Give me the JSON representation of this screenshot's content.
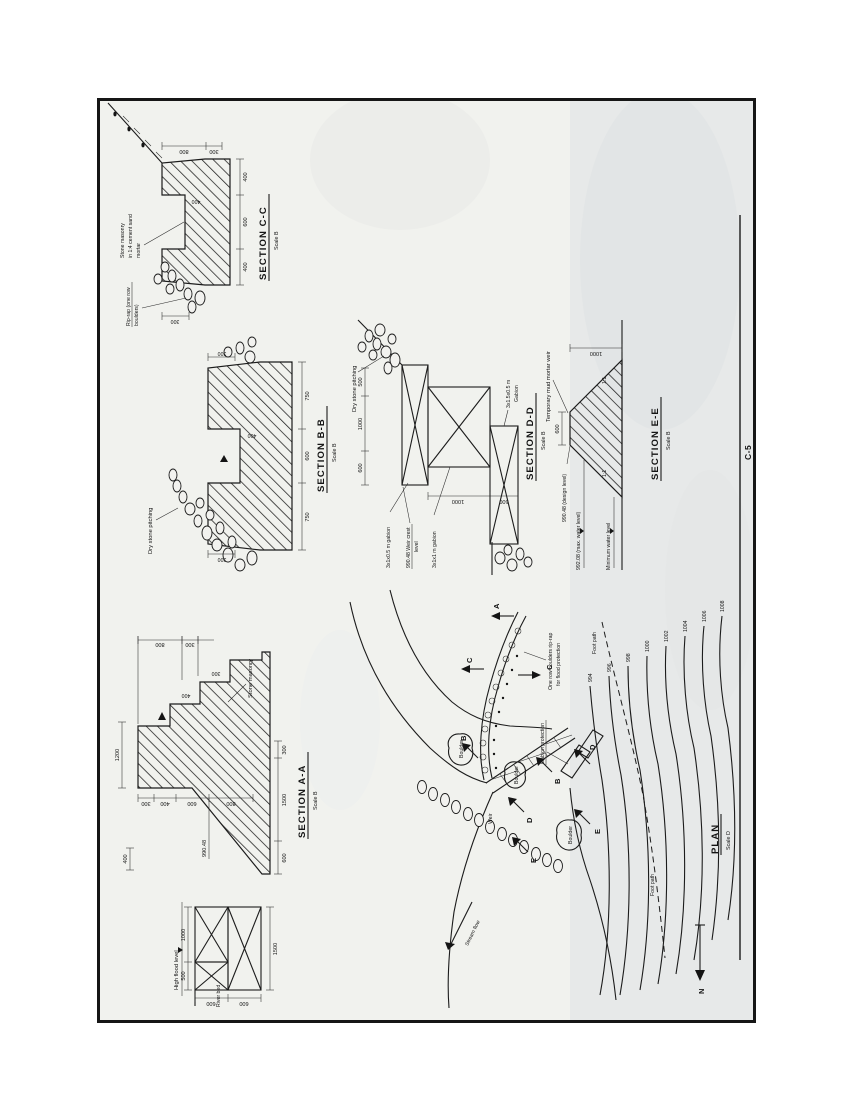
{
  "sheet": {
    "number": "C-5"
  },
  "sections": {
    "aa": {
      "title": "SECTION A-A",
      "scale": "Scale B",
      "labels": {
        "stone_masonry": "Stone masonry",
        "high_flood_level": "High flood level",
        "river_bed": "River bed",
        "crest_level": "990.48"
      },
      "dims": {
        "top_400": "400",
        "top_1200": "1200",
        "face": [
          "300",
          "400",
          "600",
          "800"
        ],
        "right": [
          "800",
          "300"
        ],
        "step": [
          "400",
          "300"
        ],
        "gabion_top": [
          "500",
          "1000"
        ],
        "gabion_left": [
          "600",
          "600"
        ],
        "gabion_width": "1500",
        "bottom": [
          "600",
          "1500",
          "300"
        ]
      }
    },
    "bb": {
      "title": "SECTION B-B",
      "scale": "Scale B",
      "labels": {
        "dry_stone": "Dry stone pitching"
      },
      "dims": {
        "bottom": [
          "750",
          "600",
          "750"
        ],
        "left_300": "300",
        "right_300": "300",
        "notch_400": "400"
      }
    },
    "cc": {
      "title": "SECTION C-C",
      "scale": "Scale B",
      "labels": {
        "riprap_1": "Rip-rap (one row",
        "riprap_2": "boulders)",
        "masonry_1": "Stone masonry",
        "masonry_2": "in 1:4 cement sand",
        "masonry_3": "mortar"
      },
      "dims": {
        "bottom": [
          "400",
          "600",
          "400"
        ],
        "right": [
          "800",
          "300"
        ],
        "left_300": "300",
        "notch_400": "400"
      }
    },
    "dd": {
      "title": "SECTION D-D",
      "scale": "Scale B",
      "labels": {
        "dry_stone": "Dry stone pitching",
        "gabion_small": "3x1x0.5 m gabion",
        "crest_1": "990.48 Weir crest",
        "crest_2": "level",
        "gabion_big": "3x1x1 m gabion",
        "gabion_right_1": "3x1.5x0.5 m",
        "gabion_right_2": "Gabion"
      },
      "dims": {
        "top": [
          "600",
          "1000",
          "500"
        ],
        "left": [
          "1000",
          "500"
        ]
      }
    },
    "ee": {
      "title": "SECTION E-E",
      "scale": "Scale B",
      "labels": {
        "temporary": "Temporary mud mortar weir",
        "design_level": "990.48 (design level)",
        "max_water": "992.08 (max. water level)",
        "min_water": "Minimum water level",
        "slope_left": "1:1",
        "slope_right": "1:1"
      },
      "dims": {
        "crest": "600",
        "height": "1000"
      }
    }
  },
  "plan": {
    "title": "PLAN",
    "scale": "Scale D",
    "labels": {
      "weir": "Weir",
      "gabion_protection": "Gabion protection",
      "one_row_1": "One row boulders rip-rap",
      "one_row_2": "for flood protection",
      "boulder": "Boulder",
      "stream_flow": "Stream flow",
      "foot_path": "Foot path",
      "north": "N"
    },
    "cuts": {
      "a": "A",
      "b": "B",
      "c": "C",
      "d": "D",
      "e": "E"
    },
    "contours": [
      "994",
      "996",
      "998",
      "1000",
      "1002",
      "1004",
      "1006",
      "1008"
    ]
  }
}
